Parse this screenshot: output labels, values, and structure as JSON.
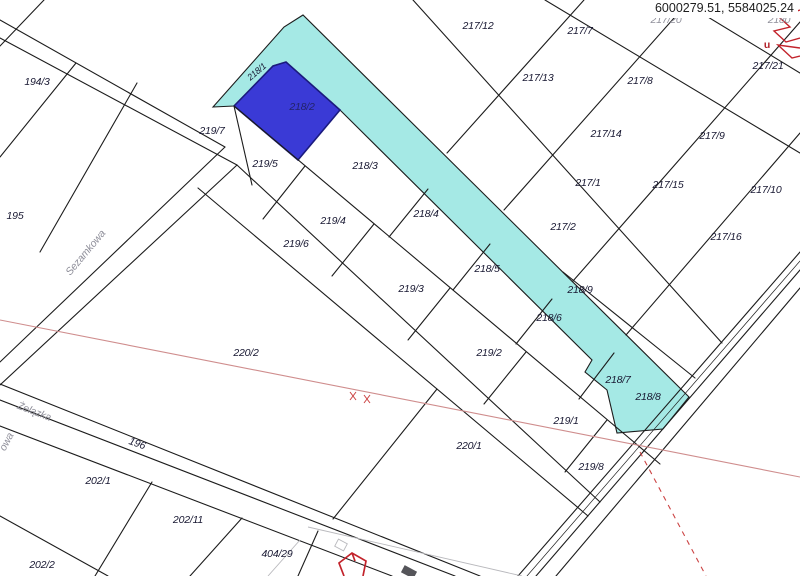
{
  "map": {
    "coordinates_display": "6000279.51, 5584025.24",
    "selected_parcel": {
      "label": "218/2",
      "fill": "#3a3ad6",
      "border": "#1b1b7e"
    },
    "road_strip": {
      "label": "218/9",
      "fill": "#a5e9e5"
    },
    "red_annotation_text": "u",
    "street_names": [
      {
        "text": "Sezamkowa",
        "x": 86,
        "y": 253,
        "r": -50
      },
      {
        "text": "Żelązka",
        "x": 34,
        "y": 412,
        "r": 21
      },
      {
        "text": "owa",
        "x": 7,
        "y": 442,
        "r": -62
      }
    ],
    "parcel_labels": [
      {
        "t": "194/3",
        "x": 37,
        "y": 82,
        "r": 0,
        "c": "d"
      },
      {
        "t": "195",
        "x": 15,
        "y": 216,
        "r": 0,
        "c": "d"
      },
      {
        "t": "217/12",
        "x": 478,
        "y": 26,
        "r": 0,
        "c": "d"
      },
      {
        "t": "217/7",
        "x": 580,
        "y": 31,
        "r": 0,
        "c": "d"
      },
      {
        "t": "217/13",
        "x": 538,
        "y": 78,
        "r": 0,
        "c": "d"
      },
      {
        "t": "217/8",
        "x": 640,
        "y": 81,
        "r": 0,
        "c": "d"
      },
      {
        "t": "217/21",
        "x": 768,
        "y": 66,
        "r": 0,
        "c": "d"
      },
      {
        "t": "217/14",
        "x": 606,
        "y": 134,
        "r": 0,
        "c": "d"
      },
      {
        "t": "217/9",
        "x": 712,
        "y": 136,
        "r": 0,
        "c": "d"
      },
      {
        "t": "217/1",
        "x": 588,
        "y": 183,
        "r": 0,
        "c": "d"
      },
      {
        "t": "217/15",
        "x": 668,
        "y": 185,
        "r": 0,
        "c": "d"
      },
      {
        "t": "217/10",
        "x": 766,
        "y": 190,
        "r": 0,
        "c": "d"
      },
      {
        "t": "217/2",
        "x": 563,
        "y": 227,
        "r": 0,
        "c": "d"
      },
      {
        "t": "217/16",
        "x": 726,
        "y": 237,
        "r": 0,
        "c": "d"
      },
      {
        "t": "217/20",
        "x": 666,
        "y": 20,
        "r": 0,
        "c": "g"
      },
      {
        "t": "2180",
        "x": 779,
        "y": 20,
        "r": 0,
        "c": "g"
      },
      {
        "t": "218/1",
        "x": 257,
        "y": 72,
        "r": -40,
        "c": "d",
        "small": true
      },
      {
        "t": "218/2",
        "x": 302,
        "y": 107,
        "r": 0,
        "c": "b"
      },
      {
        "t": "218/3",
        "x": 365,
        "y": 166,
        "r": 0,
        "c": "d"
      },
      {
        "t": "218/4",
        "x": 426,
        "y": 214,
        "r": 0,
        "c": "d"
      },
      {
        "t": "218/5",
        "x": 487,
        "y": 269,
        "r": 0,
        "c": "d"
      },
      {
        "t": "218/6",
        "x": 549,
        "y": 318,
        "r": 0,
        "c": "d"
      },
      {
        "t": "218/7",
        "x": 618,
        "y": 380,
        "r": 0,
        "c": "d"
      },
      {
        "t": "218/8",
        "x": 648,
        "y": 397,
        "r": 0,
        "c": "d"
      },
      {
        "t": "218/9",
        "x": 580,
        "y": 290,
        "r": 0,
        "c": "d"
      },
      {
        "t": "219/5",
        "x": 265,
        "y": 164,
        "r": 0,
        "c": "d"
      },
      {
        "t": "219/4",
        "x": 333,
        "y": 221,
        "r": 0,
        "c": "d"
      },
      {
        "t": "219/3",
        "x": 411,
        "y": 289,
        "r": 0,
        "c": "d"
      },
      {
        "t": "219/2",
        "x": 489,
        "y": 353,
        "r": 0,
        "c": "d"
      },
      {
        "t": "219/1",
        "x": 566,
        "y": 421,
        "r": 0,
        "c": "d"
      },
      {
        "t": "219/6",
        "x": 296,
        "y": 244,
        "r": 0,
        "c": "d"
      },
      {
        "t": "219/7",
        "x": 212,
        "y": 131,
        "r": 0,
        "c": "d"
      },
      {
        "t": "219/8",
        "x": 591,
        "y": 467,
        "r": 0,
        "c": "d"
      },
      {
        "t": "220/2",
        "x": 246,
        "y": 353,
        "r": 0,
        "c": "d"
      },
      {
        "t": "220/1",
        "x": 469,
        "y": 446,
        "r": 0,
        "c": "d"
      },
      {
        "t": "196",
        "x": 137,
        "y": 444,
        "r": 20,
        "c": "d"
      },
      {
        "t": "202/1",
        "x": 98,
        "y": 481,
        "r": 0,
        "c": "d"
      },
      {
        "t": "202/11",
        "x": 188,
        "y": 520,
        "r": 0,
        "c": "d"
      },
      {
        "t": "202/2",
        "x": 42,
        "y": 565,
        "r": 0,
        "c": "d"
      },
      {
        "t": "404/29",
        "x": 277,
        "y": 554,
        "r": 0,
        "c": "d"
      }
    ]
  }
}
